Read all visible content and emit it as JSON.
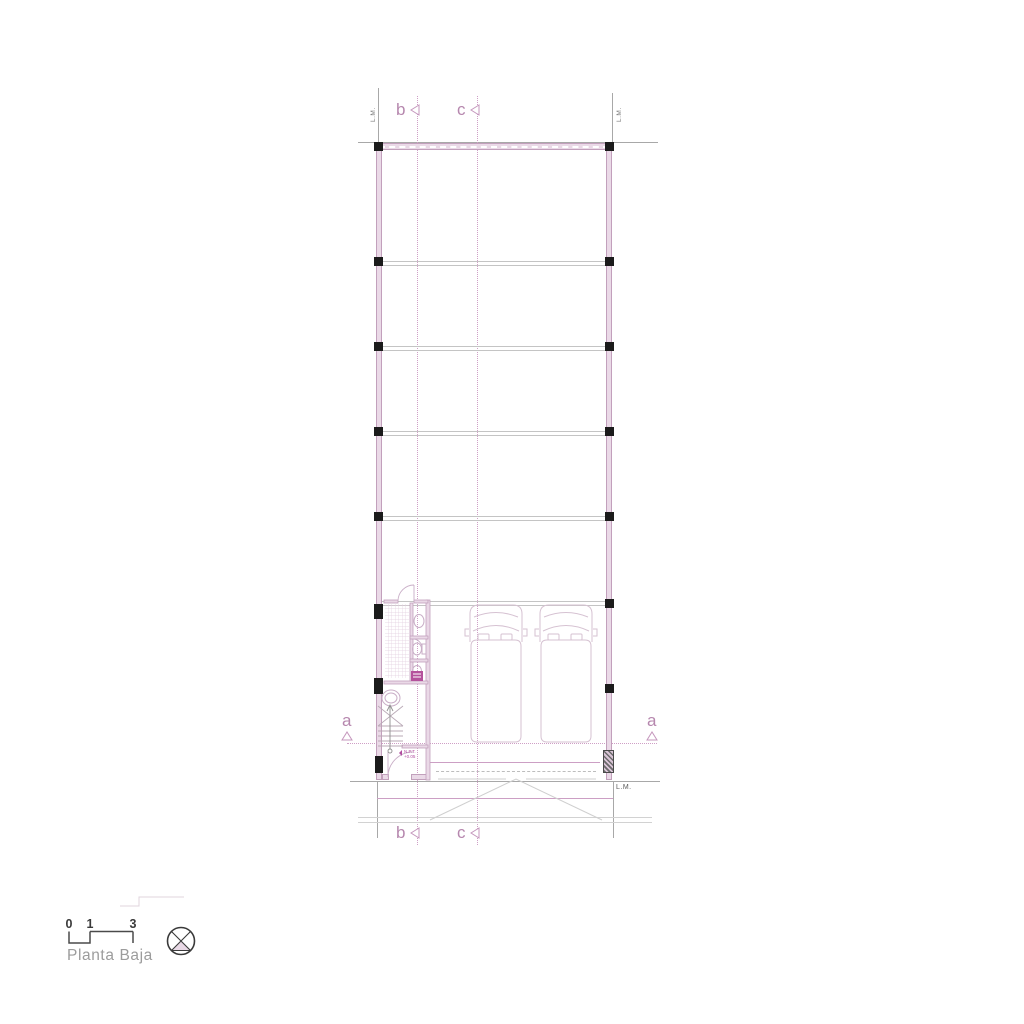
{
  "plan": {
    "grid": {
      "b": "b",
      "c": "c",
      "a": "a"
    },
    "annotations": {
      "property_line": "L.M.",
      "npt_line1": "N.P.T.",
      "npt_line2": "+0.05"
    },
    "legend": {
      "scale_ticks": [
        "0",
        "1",
        "3"
      ],
      "title": "Planta Baja"
    },
    "colors": {
      "wall_fill": "#ead9e7",
      "wall_edge": "#c2a0bc",
      "grid_pink": "#cf9fc6",
      "axis_label": "#b687ae",
      "beam_gray": "#c4c4c4",
      "boundary_gray": "#a8a8a8",
      "column_black": "#1b1b1b",
      "fixture_pink": "#c9aec7",
      "accent_magenta": "#b14ea0",
      "title_gray": "#9c9c9c",
      "scale_text": "#3a3a3a"
    }
  }
}
